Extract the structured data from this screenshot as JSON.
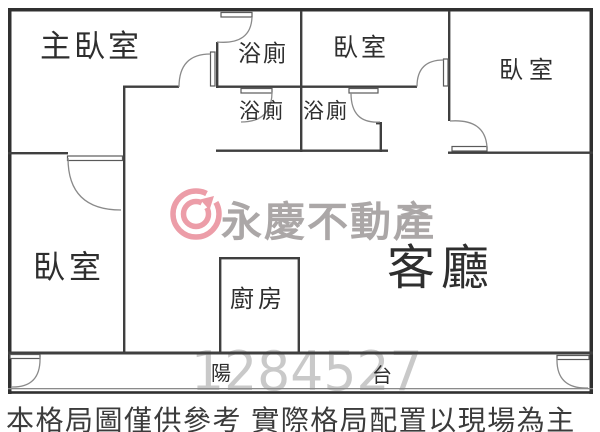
{
  "watermarks": {
    "brand": "永慶不動產",
    "serial": "1284527"
  },
  "rooms": {
    "master_bedroom": "主臥室",
    "bath_top": "浴廁",
    "bedroom_mid": "臥室",
    "bedroom_right": "臥室",
    "bath_mid_left": "浴廁",
    "bath_mid_right": "浴廁",
    "bedroom_lower_left": "臥室",
    "kitchen": "廚房",
    "living_room": "客廳",
    "balcony_char_left": "陽",
    "balcony_char_right": "台"
  },
  "disclaimer": "本格局圖僅供參考 實際格局配置以現場為主",
  "colors": {
    "wall_outer": "#303030",
    "wall_inner": "#3f3f3f",
    "door_arc": "#8a8a8a",
    "label_text": "#2e2e2e",
    "logo_pink": "#ec9da8",
    "logo_text_gray": "#aba7a7",
    "serial_gray": "#c9c9c9",
    "disclaimer_text": "#3b3b3b"
  }
}
